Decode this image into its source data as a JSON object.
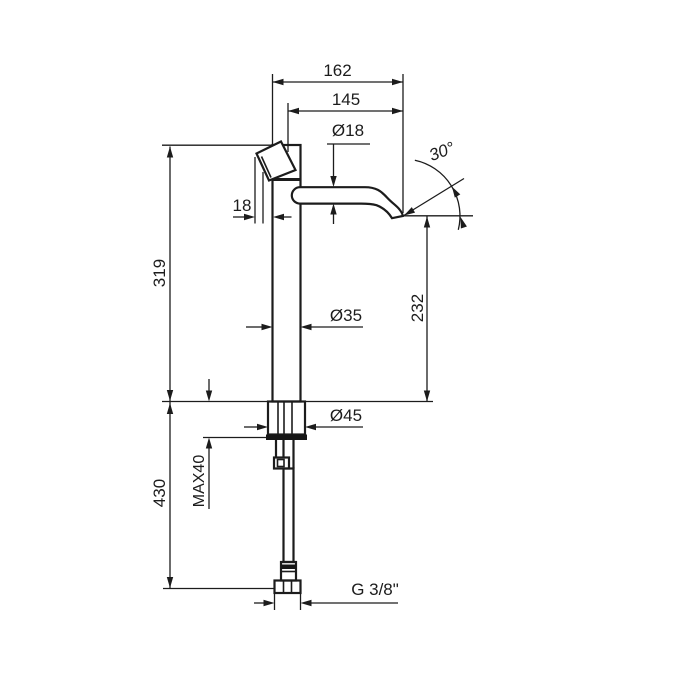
{
  "drawing": {
    "type": "technical-dimension-drawing",
    "subject": "tall single-lever basin mixer tap, side elevation with dimensions",
    "colors": {
      "line_color": "#1c1c1c",
      "background": "#ffffff"
    },
    "labels": {
      "reach_overall": "162",
      "reach_aerator": "145",
      "spout_diameter": "Ø18",
      "spout_angle": "30°",
      "handle_offset": "18",
      "body_height": "319",
      "body_diameter": "Ø35",
      "spout_outlet_height": "232",
      "base_diameter": "Ø45",
      "max_counter_thickness": "MAX40",
      "hose_length": "430",
      "thread_size": "G 3/8\""
    }
  }
}
